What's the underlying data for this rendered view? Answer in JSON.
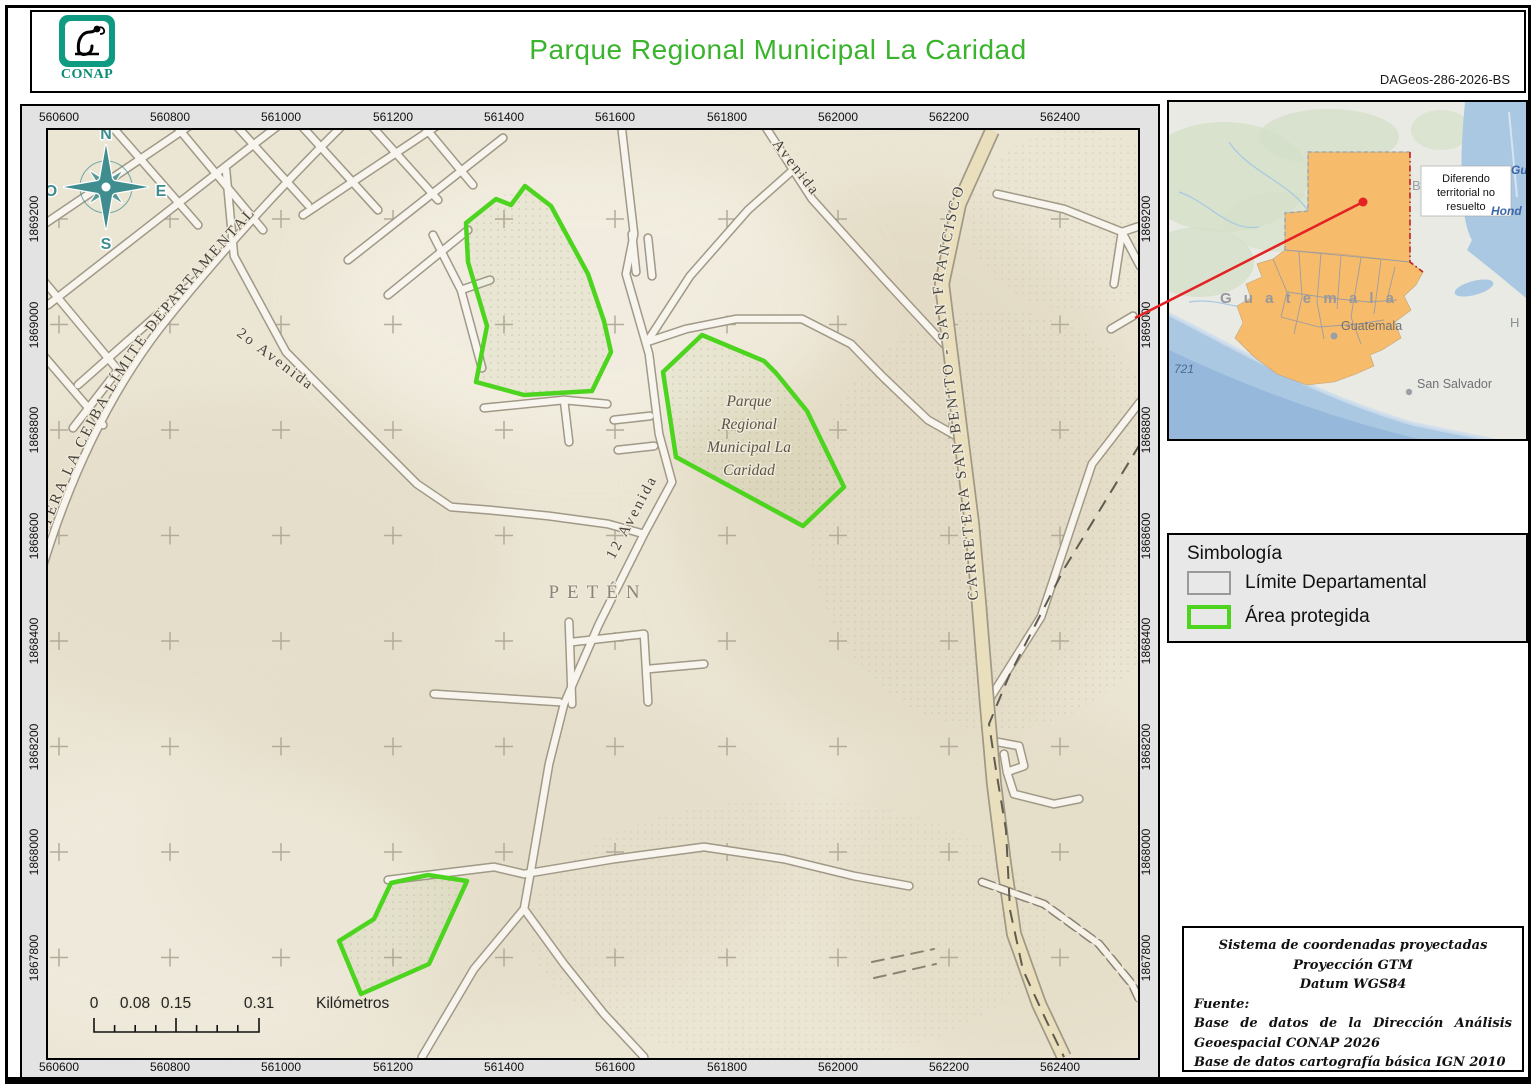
{
  "header": {
    "logo_text": "CONAP",
    "title": "Parque Regional Municipal La Caridad",
    "doc_code": "DAGeos-286-2026-BS"
  },
  "compass": {
    "n": "N",
    "e": "E",
    "s": "S",
    "o": "O"
  },
  "map": {
    "grid": {
      "x_labels": [
        "560600",
        "560800",
        "561000",
        "561200",
        "561400",
        "561600",
        "561800",
        "562000",
        "562200",
        "562400"
      ],
      "y_labels": [
        "1869200",
        "1869000",
        "1868800",
        "1868600",
        "1868400",
        "1868200",
        "1868000",
        "1867800"
      ]
    },
    "labels": {
      "department": "PETÉN",
      "park": [
        "Parque",
        "Regional",
        "Municipal La",
        "Caridad"
      ],
      "road_ceiba": "CARRETERA LA CEIBA LÍMITE DEPARTAMENTAL",
      "road_2a": "2o Avenida",
      "road_12a": "12 Avenida",
      "road_avenida": "Avenida",
      "road_sanbenito": "CARRETERA SAN BENITO - SAN FRANCISCO"
    },
    "scalebar": {
      "l0": "0",
      "l1": "0.08",
      "l2": "0.15",
      "l3": "0.31",
      "unit": "Kilómetros"
    }
  },
  "inset": {
    "note": "Diferendo territorial no resuelto",
    "note_lines": [
      "Diferendo",
      "territorial no",
      "resuelto"
    ],
    "country_label": "G u a t e m a l a",
    "city_label": "Guatemala",
    "san_salvador": "San Salvador",
    "number": "721",
    "fragment_hond": "Hond",
    "fragment_ho": "H o",
    "fragment_gu": "Gu",
    "fragment_b": "B"
  },
  "legend": {
    "title": "Simbología",
    "items": [
      {
        "label": "Límite Departamental",
        "type": "gray"
      },
      {
        "label": "Área protegida",
        "type": "green"
      }
    ]
  },
  "credits": {
    "line1": "Sistema de coordenadas proyectadas",
    "line2": "Proyección GTM",
    "line3": "Datum WGS84",
    "fuente_label": "Fuente:",
    "source1": "Base de datos de la Dirección Análisis Geoespacial CONAP 2026",
    "source2": "Base de datos cartografía básica IGN 2010"
  },
  "colors": {
    "title_green": "#3ab32d",
    "conap_teal": "#0f9b82",
    "compass_teal": "#3f8d8f",
    "protected_green": "#4cd41f",
    "guatemala_orange": "#f6bb6b",
    "water_blue": "#abc8e2",
    "map_paper": "#ebe5d4",
    "leader_red": "#e32222"
  }
}
